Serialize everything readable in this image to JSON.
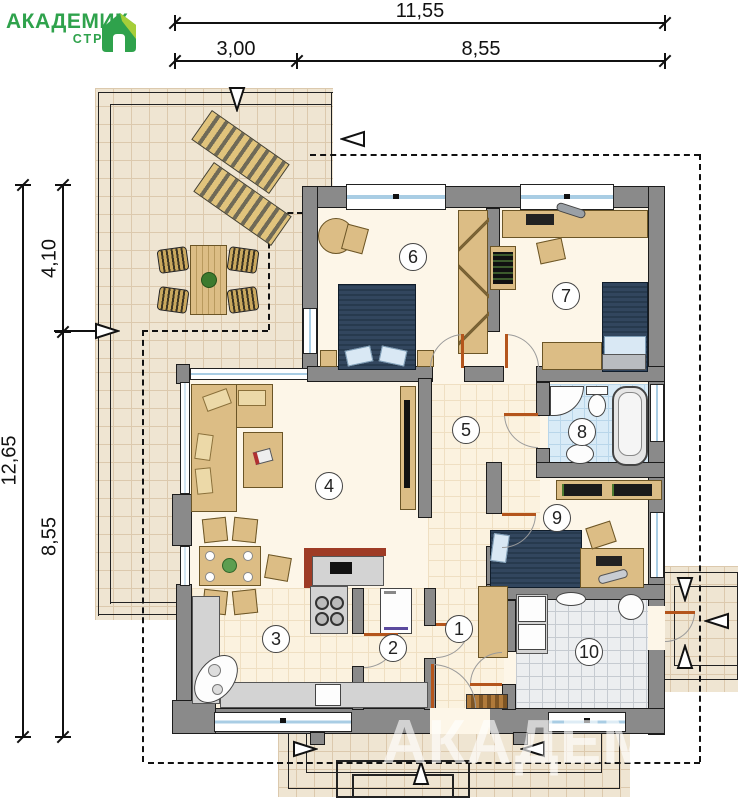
{
  "logo": {
    "title": "АКАДЕМИК",
    "subtitle": "СТРОЙ"
  },
  "dimensions": {
    "top_total": "11,55",
    "top_left": "3,00",
    "top_right": "8,55",
    "side_total": "12,65",
    "side_upper": "4,10",
    "side_lower": "8,55"
  },
  "rooms": [
    "1",
    "2",
    "3",
    "4",
    "5",
    "6",
    "7",
    "8",
    "9",
    "10"
  ],
  "watermark": "АКАДЕМИК",
  "colors": {
    "logo_green": "#2fa24c",
    "logo_lime": "#a6ce39",
    "wall_gray": "#8a8a8a",
    "bed_navy": "#32465e",
    "furniture_tan": "#dcbd85",
    "terrace_tile": "#efe5d2",
    "bath_tile": "#d9ebf7",
    "door_orange": "#b4551c"
  }
}
